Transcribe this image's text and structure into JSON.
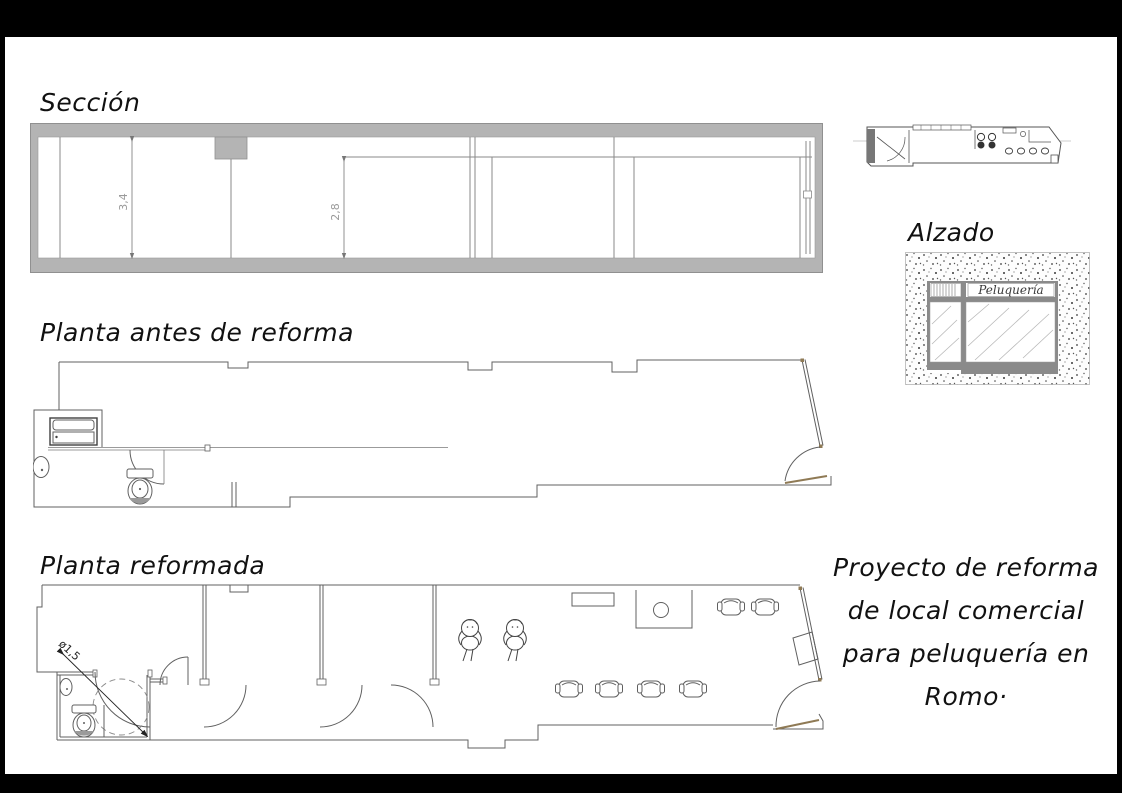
{
  "page": {
    "background": "#000000",
    "paper": "#ffffff"
  },
  "titles": {
    "section": "Sección",
    "plan_before": "Planta antes de reforma",
    "plan_after": "Planta reformada",
    "elevation": "Alzado"
  },
  "section_view": {
    "dim_height_total": "3,4",
    "dim_height_ceiling": "2,8"
  },
  "elevation_view": {
    "sign": "Peluquería"
  },
  "plan_after_view": {
    "turning_circle": "ø1,5"
  },
  "project_note": {
    "lines": [
      "Proyecto de reforma",
      "de local comercial",
      "para peluquería en",
      "Romo·"
    ]
  },
  "palette": {
    "wall_gray": "#b4b4b4",
    "line_gray": "#8a8a8a",
    "plan_line": "#606060",
    "door_tan": "#8f7a55",
    "dim_text": "#9a9a9a"
  }
}
